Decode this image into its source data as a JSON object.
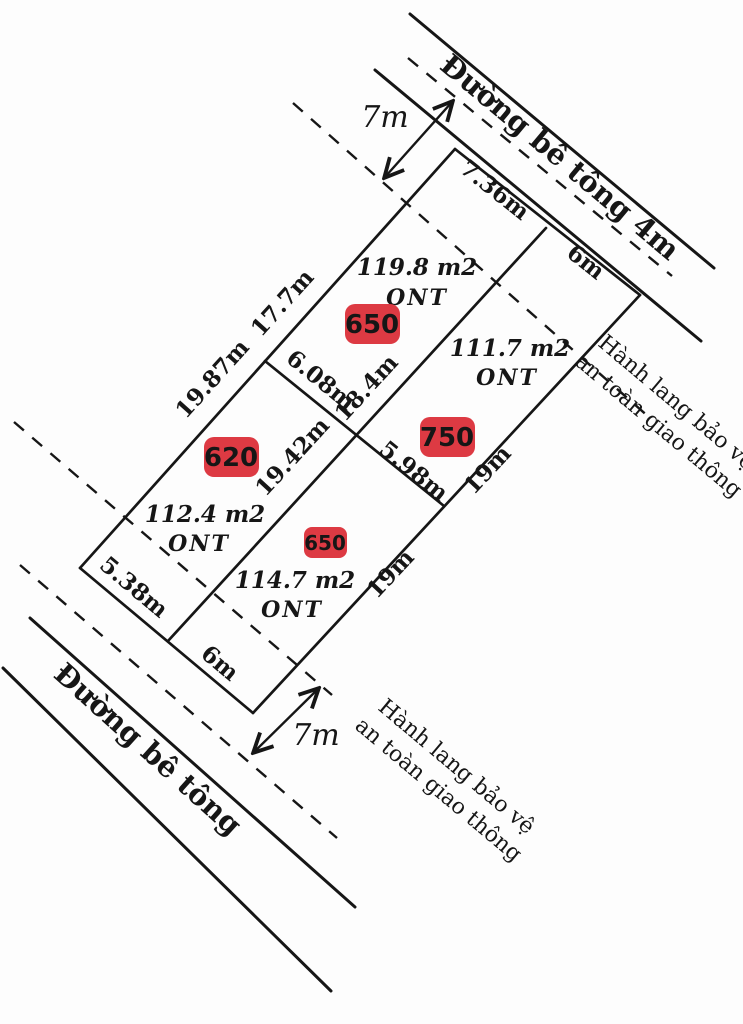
{
  "roads": {
    "top_label": "Đường bê tông 4m",
    "bottom_label": "Đường bê tông"
  },
  "corridor": {
    "line1": "Hành lang bảo vệ",
    "line2": "an toàn giao thông"
  },
  "setbacks": {
    "top": "7m",
    "bottom": "7m"
  },
  "plots": {
    "a": {
      "area": "119.8 m2",
      "land_use": "ONT",
      "price_badge": "650"
    },
    "b": {
      "area": "111.7 m2",
      "land_use": "ONT",
      "price_badge": "750"
    },
    "c": {
      "area": "112.4 m2",
      "land_use": "ONT",
      "price_badge": "620"
    },
    "d": {
      "area": "114.7 m2",
      "land_use": "ONT",
      "price_badge": "650"
    }
  },
  "dimensions": {
    "plot_a_frontage": "7.36m",
    "plot_b_frontage": "6m",
    "plot_a_left": "17.7m",
    "plot_c_left": "19.87m",
    "middle_left": "6.08m",
    "divider_ab": "18.4m",
    "divider_cd": "19.42m",
    "middle_right": "5.98m",
    "plot_b_right": "19m",
    "plot_d_right": "19m",
    "plot_c_frontage": "5.38m",
    "plot_d_frontage": "6m"
  },
  "colors": {
    "badge_bg": "#dd3a43",
    "badge_text": "#ffffff",
    "ink": "#161616",
    "background": "#fdfdfd"
  }
}
